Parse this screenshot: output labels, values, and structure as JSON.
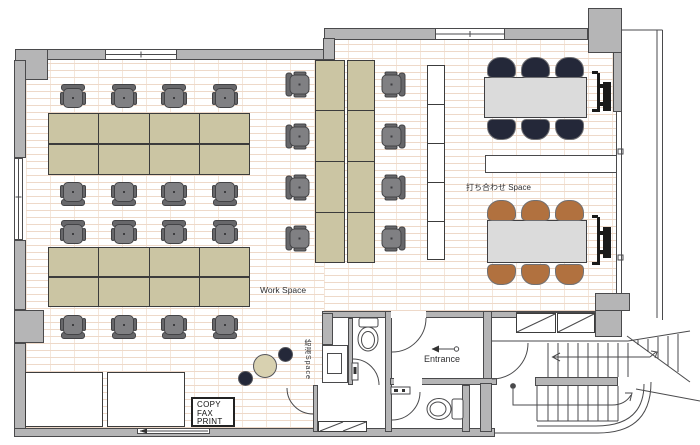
{
  "labels": {
    "work_space": "Work Space",
    "meeting_space": "打ち合わせ Space",
    "entrance": "Entrance",
    "kitchen": "給湯Space",
    "copy_station": [
      "COPY",
      "FAX",
      "PRINT"
    ]
  },
  "colors": {
    "wall": "#b5b5b6",
    "line": "#4a4a4c",
    "floor_line": "#eed9c9",
    "floor_line2": "#f4e6da",
    "desk": "#cbc5a3",
    "desk_line": "#3c3c3c",
    "chair": "#808083",
    "chair_back": "#67676a",
    "chair_line": "#434346",
    "meeting_table": "#dbdbdb",
    "navy": "#242839",
    "brown": "#b1713f",
    "stool_table": "#d8d1b0",
    "text": "#2f2f31"
  }
}
